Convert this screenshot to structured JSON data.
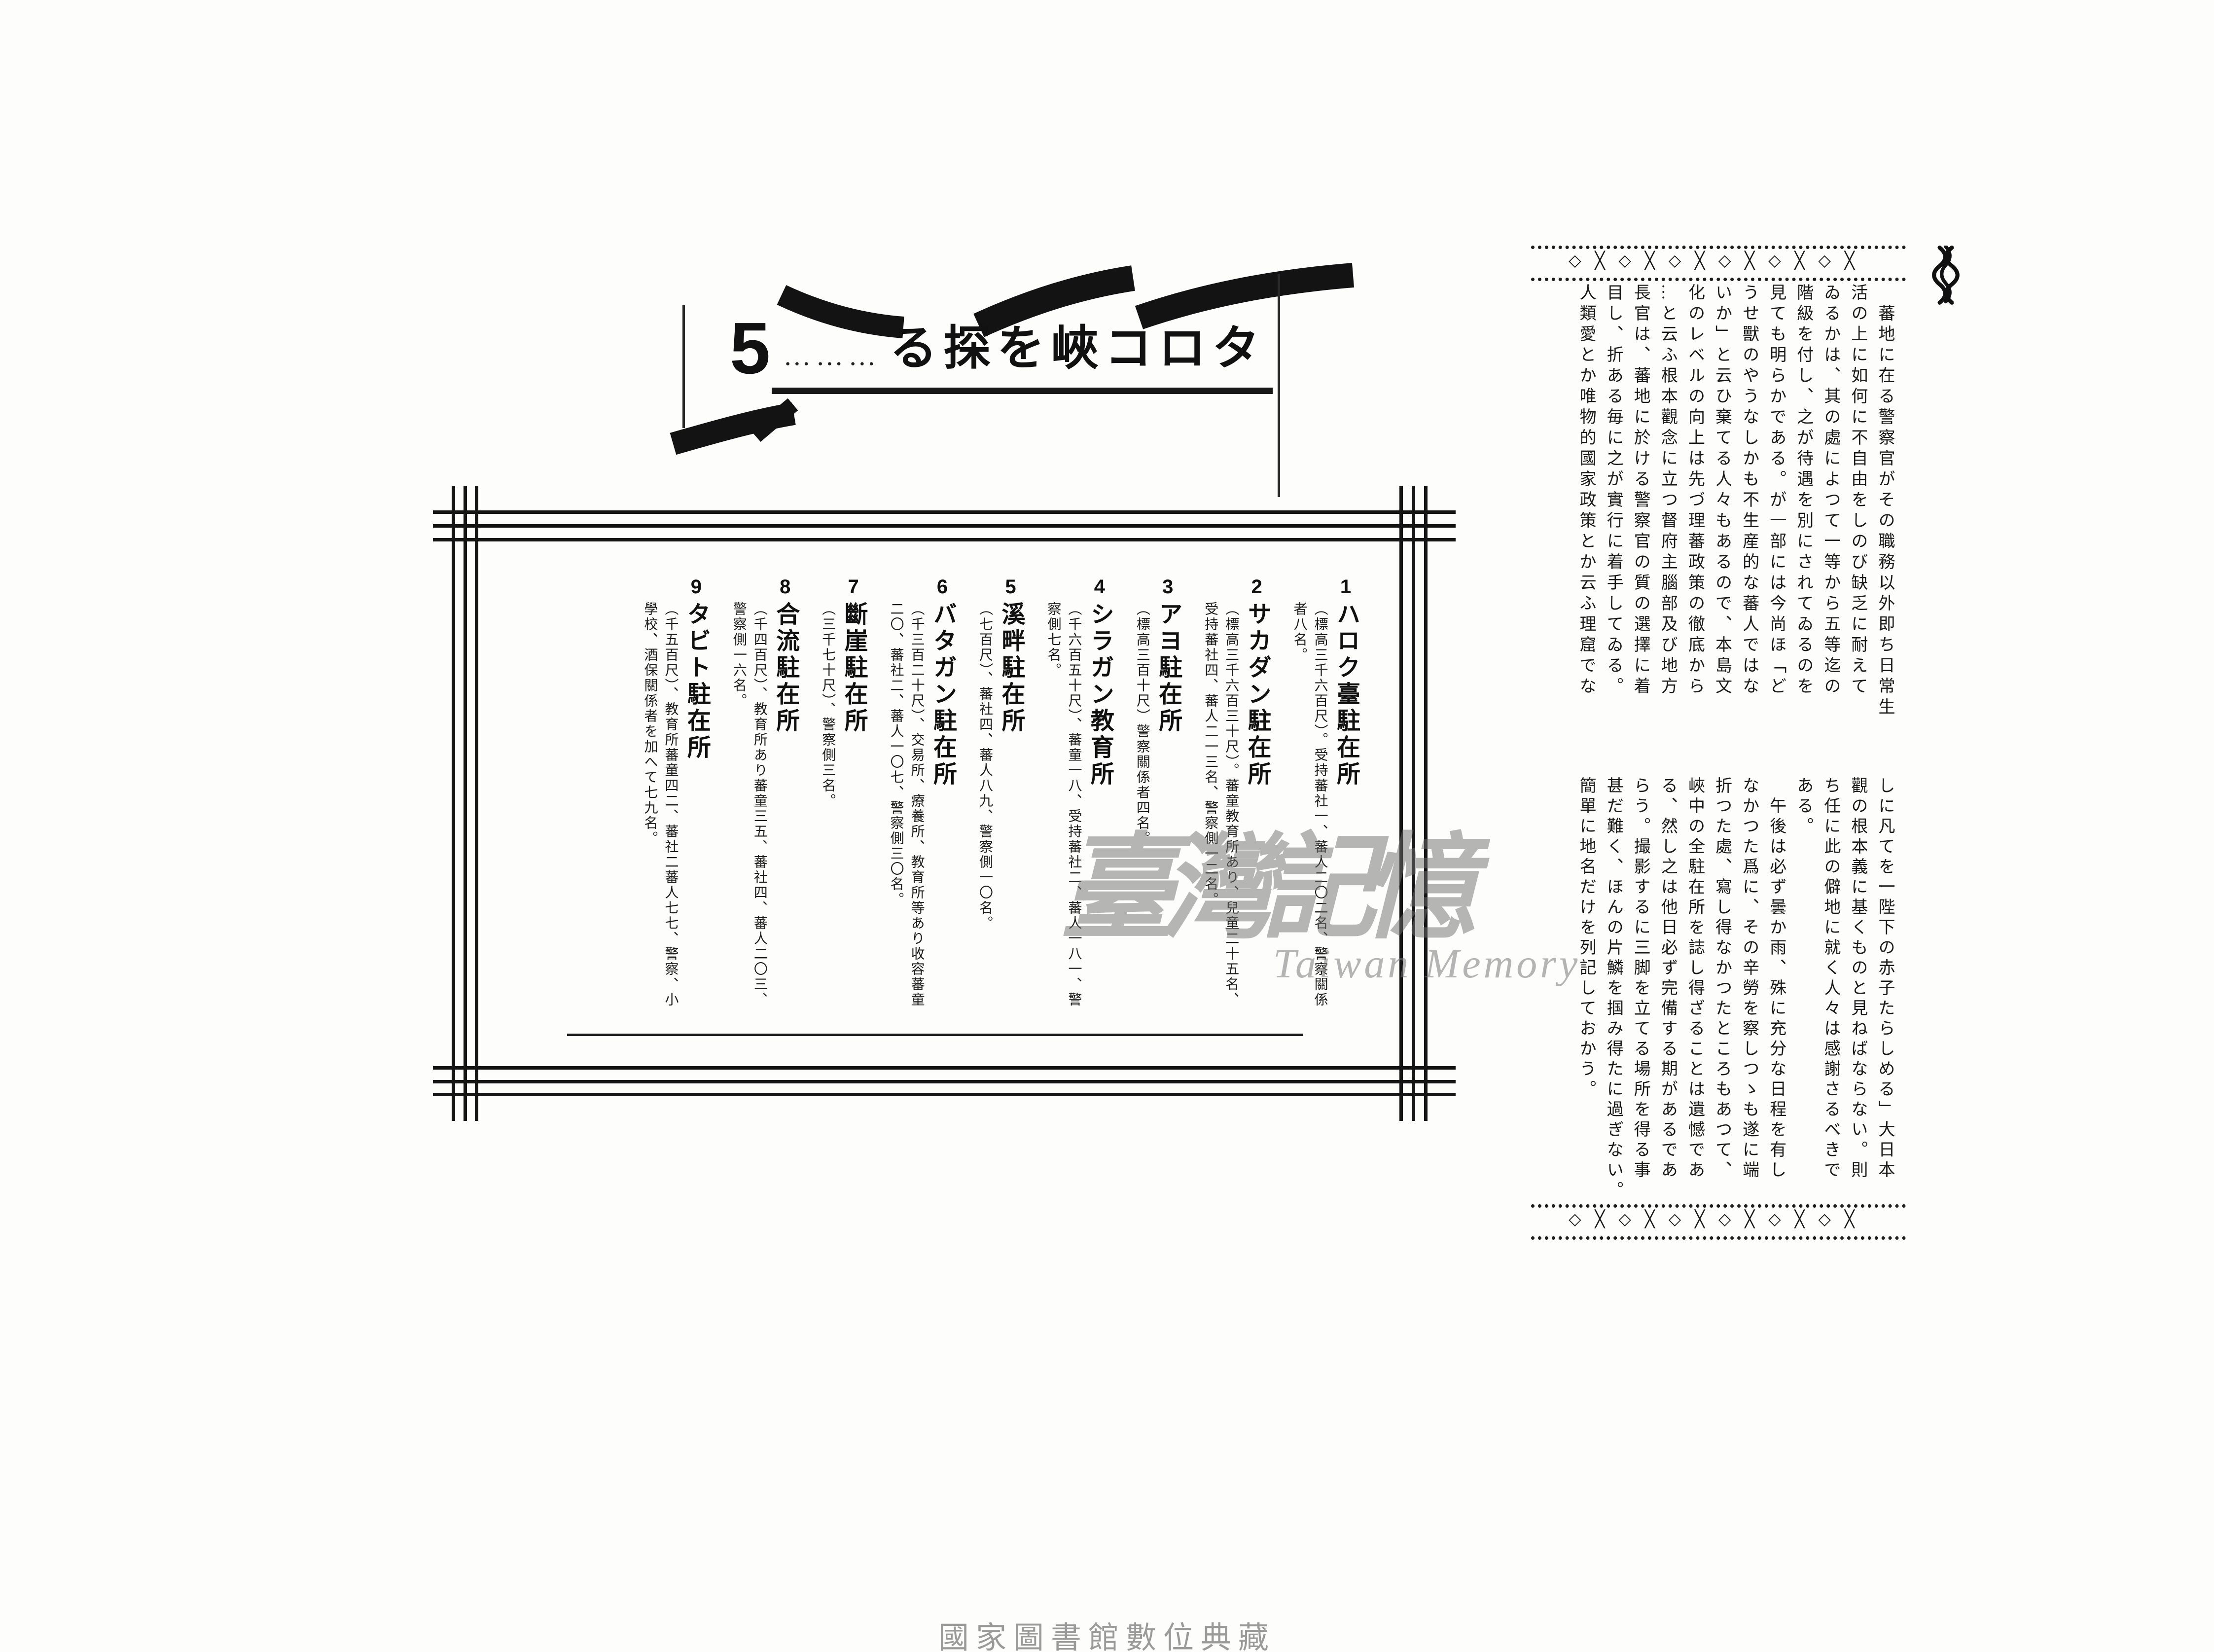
{
  "document": {
    "section_title": {
      "number": "5",
      "leader": "………",
      "title_rtl": "る探を峽コロタ"
    },
    "ornament": {
      "band_glyphs": "◇╳◇╳◇╳◇╳◇╳◇╳",
      "icons": {
        "emblem": "weave-knot-icon"
      }
    },
    "body": {
      "block1": "　蕃地に在る警察官がその職務以外即ち日常生\n活の上に如何に不自由をしのび缺乏に耐えて\nゐるかは、其の處によつて一等から五等迄の\n階級を付し、之が待遇を別にされてゐるのを\n見ても明らかである。が一部には今尚ほ「ど\nうせ獸のやうなしかも不生産的な蕃人ではな\nいか」と云ひ棄てる人々もあるので、本島文\n化のレベルの向上は先づ理蕃政策の徹底から\n…と云ふ根本觀念に立つ督府主腦部及び地方\n長官は、蕃地に於ける警察官の質の選擇に着\n目し、折ある毎に之が實行に着手してゐる。\n人類愛とか唯物的國家政策とか云ふ理窟でな",
      "block2": "しに凡てを一陛下の赤子たらしめる」大日本\n觀の根本義に基くものと見ねばならない。則\nち任に此の僻地に就く人々は感謝さるべきで\nある。\n　午後は必ず曇か雨、殊に充分な日程を有し\nなかつた爲に、その辛勞を察しつゝも遂に端\n折つた處、寫し得なかつたところもあつて、\n峽中の全駐在所を誌し得ざることは遺憾であ\nる、然し之は他日必ず完備する期があるであ\nらう。撮影するに三脚を立てる場所を得る事\n甚だ難く、ほんの片鱗を掴み得たに過ぎない。\n簡單に地名だけを列記しておかう。"
    },
    "stations": {
      "items": [
        {
          "no": "1",
          "name": "ハロク臺駐在所",
          "detail": "（標高三千六百尺）。受持蕃社一、蕃人二〇二名、警察關係\n者八名。"
        },
        {
          "no": "2",
          "name": "サカダン駐在所",
          "detail": "（標高三千六百三十尺）。蕃童教育所あり、兒童二十五名、\n受持蕃社四、蕃人二一三名、警察側一二名。"
        },
        {
          "no": "3",
          "name": "アヨ駐在所",
          "detail": "（標高三百十尺）警察關係者四名。"
        },
        {
          "no": "4",
          "name": "シラガン教育所",
          "detail": "（千六百五十尺）、蕃童一八、受持蕃社二、蕃人一八一、警\n察側七名。"
        },
        {
          "no": "5",
          "name": "溪畔駐在所",
          "detail": "（七百尺）、蕃社四、蕃人八九、警察側一〇名。"
        },
        {
          "no": "6",
          "name": "バタガン駐在所",
          "detail": "（千三百二十尺）、交易所、療養所、教育所等あり收容蕃童\n二〇、蕃社二、蕃人一〇七、警察側三〇名。"
        },
        {
          "no": "7",
          "name": "斷崖駐在所",
          "detail": "（三千七十尺）、警察側三名。"
        },
        {
          "no": "8",
          "name": "合流駐在所",
          "detail": "（千四百尺）、教育所あり蕃童三五、蕃社四、蕃人二〇三、\n警察側一六名。"
        },
        {
          "no": "9",
          "name": "タビト駐在所",
          "detail": "（千五百尺）、教育所蕃童四二、蕃社二蕃人七七、警察、小\n學校、酒保關係者を加へて七九名。"
        }
      ]
    },
    "watermark": {
      "cjk": "臺灣記憶",
      "latin": "Taiwan Memory"
    },
    "footer": "國家圖書館數位典藏"
  }
}
